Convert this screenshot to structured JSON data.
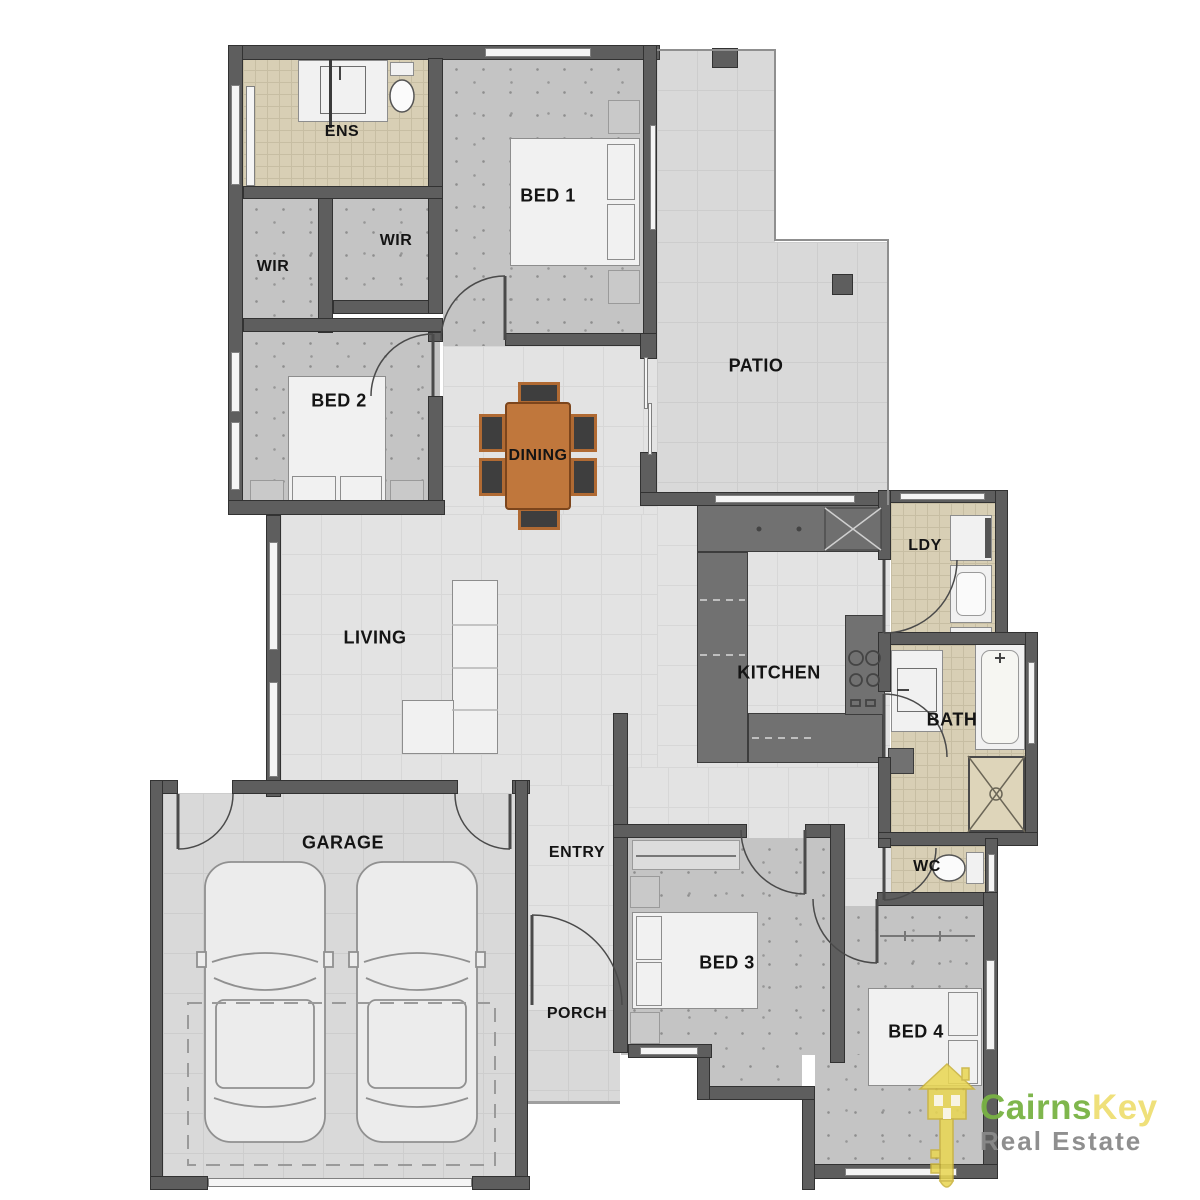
{
  "rooms": {
    "ens": {
      "label": "ENS"
    },
    "bed1": {
      "label": "BED 1"
    },
    "wir_left": {
      "label": "WIR"
    },
    "wir_right": {
      "label": "WIR"
    },
    "bed2": {
      "label": "BED 2"
    },
    "patio": {
      "label": "PATIO"
    },
    "dining": {
      "label": "DINING"
    },
    "living": {
      "label": "LIVING"
    },
    "kitchen": {
      "label": "KITCHEN"
    },
    "ldy": {
      "label": "LDY"
    },
    "bath": {
      "label": "BATH"
    },
    "wc": {
      "label": "WC"
    },
    "garage": {
      "label": "GARAGE"
    },
    "entry": {
      "label": "ENTRY"
    },
    "porch": {
      "label": "PORCH"
    },
    "bed3": {
      "label": "BED 3"
    },
    "bed4": {
      "label": "BED 4"
    }
  },
  "branding": {
    "brand_green": "Cairns",
    "brand_yellow": "Key",
    "tagline": "Real Estate"
  },
  "colors": {
    "wall": "#5e5e5e",
    "carpet": "#c4c4c4",
    "hard_floor": "#e3e3e3",
    "hard_grid": "#d7d7d7",
    "outdoor_floor": "#d9d9d9",
    "tile_floor": "#d8cfb5",
    "counter": "#717171",
    "furniture_white": "#f1f1f1",
    "dining_table": "#c0773c",
    "chair_dark": "#3e3e3e",
    "logo_green": "#79b344",
    "logo_yellow": "#efdf73",
    "logo_gray": "#8a8a8a"
  }
}
